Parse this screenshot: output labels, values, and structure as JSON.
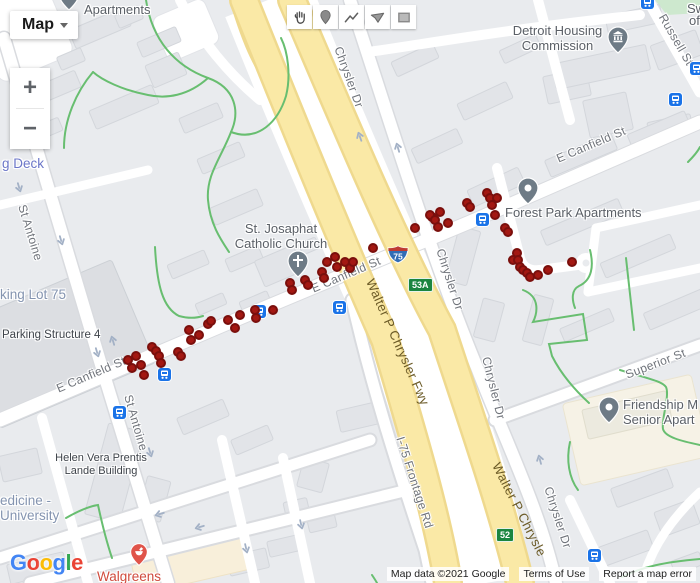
{
  "map_controls": {
    "map_type_button": "Map",
    "zoom_in": "+",
    "zoom_out": "−"
  },
  "toolbar": {
    "tools": [
      {
        "id": "pan",
        "icon": "hand-icon"
      },
      {
        "id": "marker",
        "icon": "marker-icon"
      },
      {
        "id": "polyline",
        "icon": "polyline-icon"
      },
      {
        "id": "polygon",
        "icon": "polygon-icon"
      },
      {
        "id": "rectangle",
        "icon": "rectangle-icon"
      }
    ]
  },
  "poi_labels": {
    "apartments": "Apartments",
    "sw_partial": "Sw",
    "of_partial": "of",
    "detroit_housing_1": "Detroit Housing",
    "detroit_housing_2": "Commission",
    "st_josaphat_1": "St. Josaphat",
    "st_josaphat_2": "Catholic Church",
    "forest_park": "Forest Park Apartments",
    "friendship_1": "Friendship M",
    "friendship_2": "Senior Apart",
    "parking_deck": "g Deck",
    "parking_lot": "king Lot 75",
    "parking_structure": "Parking Structure 4",
    "helen_1": "Helen Vera Prentis",
    "helen_2": "Lande Building",
    "medicine_1": "edicine -",
    "medicine_2": "University",
    "walgreens": "Walgreens"
  },
  "street_labels": {
    "e_canfield": "E Canfield St",
    "st_antoine": "St Antoine",
    "chrysler_dr": "Chrysler Dr",
    "russell_st": "Russell St",
    "superior_st": "Superior St",
    "i75_frontage": "I-75 Frontage Rd",
    "walter_p_full": "Walter P Chrysler Fwy",
    "walter_p_partial": "Walter P Chrysle"
  },
  "shields": {
    "interstate": "75",
    "exit_a": "53A",
    "exit_b": "52"
  },
  "attribution": {
    "map_data": "Map data ©2021 Google",
    "terms_of_use": "Terms of Use",
    "report_error": "Report a map error"
  },
  "google_logo": [
    {
      "ch": "G",
      "color": "#4285F4"
    },
    {
      "ch": "o",
      "color": "#EA4335"
    },
    {
      "ch": "o",
      "color": "#FBBC05"
    },
    {
      "ch": "g",
      "color": "#4285F4"
    },
    {
      "ch": "l",
      "color": "#34A853"
    },
    {
      "ch": "e",
      "color": "#EA4335"
    }
  ],
  "markers": {
    "dot_fill": "#A31812",
    "dot_stroke": "#7A0F0C",
    "dots": [
      [
        128,
        360
      ],
      [
        136,
        356
      ],
      [
        132,
        368
      ],
      [
        141,
        365
      ],
      [
        144,
        375
      ],
      [
        152,
        347
      ],
      [
        156,
        351
      ],
      [
        159,
        356
      ],
      [
        161,
        363
      ],
      [
        178,
        352
      ],
      [
        181,
        356
      ],
      [
        189,
        330
      ],
      [
        191,
        340
      ],
      [
        199,
        335
      ],
      [
        208,
        324
      ],
      [
        211,
        321
      ],
      [
        228,
        320
      ],
      [
        235,
        328
      ],
      [
        240,
        315
      ],
      [
        255,
        310
      ],
      [
        256,
        318
      ],
      [
        273,
        310
      ],
      [
        290,
        283
      ],
      [
        292,
        290
      ],
      [
        305,
        280
      ],
      [
        308,
        285
      ],
      [
        322,
        272
      ],
      [
        324,
        278
      ],
      [
        327,
        262
      ],
      [
        335,
        257
      ],
      [
        337,
        267
      ],
      [
        345,
        262
      ],
      [
        350,
        268
      ],
      [
        353,
        262
      ],
      [
        373,
        248
      ],
      [
        415,
        228
      ],
      [
        432,
        217
      ],
      [
        430,
        215
      ],
      [
        435,
        220
      ],
      [
        440,
        212
      ],
      [
        438,
        227
      ],
      [
        448,
        223
      ],
      [
        467,
        203
      ],
      [
        470,
        207
      ],
      [
        487,
        193
      ],
      [
        490,
        198
      ],
      [
        497,
        198
      ],
      [
        492,
        205
      ],
      [
        495,
        215
      ],
      [
        505,
        228
      ],
      [
        508,
        232
      ],
      [
        517,
        253
      ],
      [
        513,
        260
      ],
      [
        518,
        260
      ],
      [
        520,
        267
      ],
      [
        523,
        270
      ],
      [
        527,
        273
      ],
      [
        530,
        277
      ],
      [
        538,
        275
      ],
      [
        548,
        270
      ],
      [
        572,
        262
      ]
    ],
    "transit_stops": [
      [
        339,
        307
      ],
      [
        482,
        219
      ],
      [
        164,
        374
      ],
      [
        119,
        412
      ],
      [
        594,
        555
      ],
      [
        675,
        99
      ],
      [
        696,
        68
      ],
      [
        647,
        2
      ],
      [
        259,
        311
      ]
    ]
  }
}
